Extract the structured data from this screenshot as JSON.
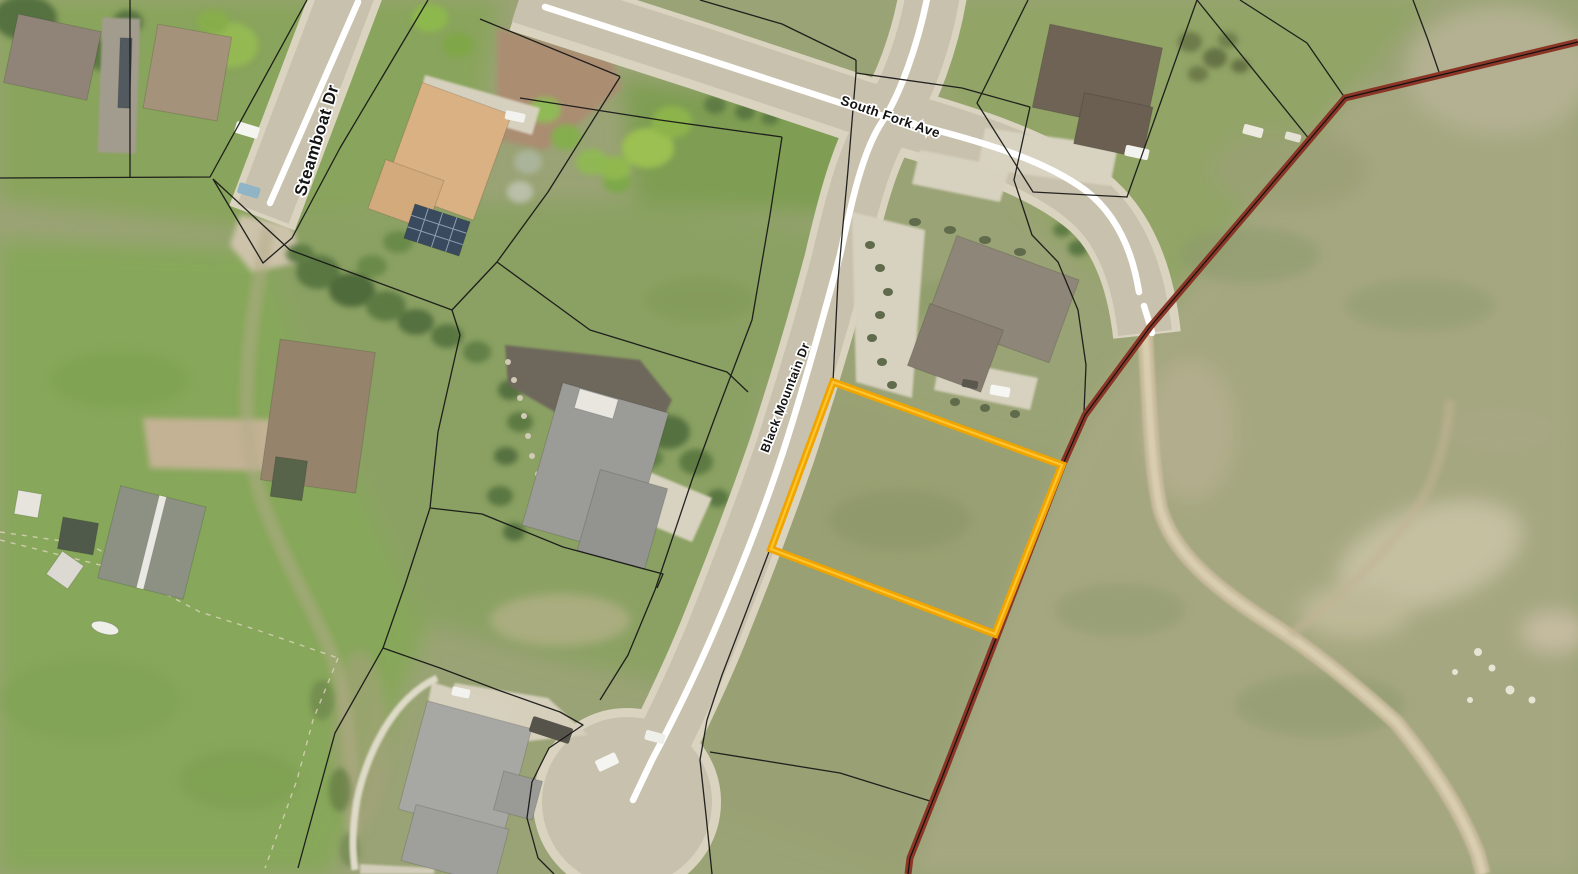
{
  "map": {
    "kind": "aerial-parcel-map",
    "street_labels": [
      {
        "id": "steamboat",
        "name": "Steamboat Dr"
      },
      {
        "id": "south-fork",
        "name": "South Fork Ave"
      },
      {
        "id": "black-mountain",
        "name": "Black Mountain Dr"
      }
    ],
    "selected_parcel": {
      "outline_color": "#EFA400",
      "inner_line_color": "#FFC52F",
      "corners_px": [
        [
          833,
          382
        ],
        [
          1062,
          465
        ],
        [
          995,
          634
        ],
        [
          771,
          549
        ]
      ]
    },
    "city_boundary": {
      "color": "#8A3526",
      "centerline_color": "#121212",
      "path_px": [
        [
          1578,
          42
        ],
        [
          1345,
          98
        ],
        [
          1150,
          327
        ],
        [
          1085,
          415
        ],
        [
          1063,
          464
        ],
        [
          997,
          636
        ],
        [
          945,
          770
        ],
        [
          910,
          858
        ],
        [
          908,
          874
        ]
      ]
    },
    "parcel_lines_color": "#151515",
    "road_centerline_color": "#FFFFFF"
  }
}
